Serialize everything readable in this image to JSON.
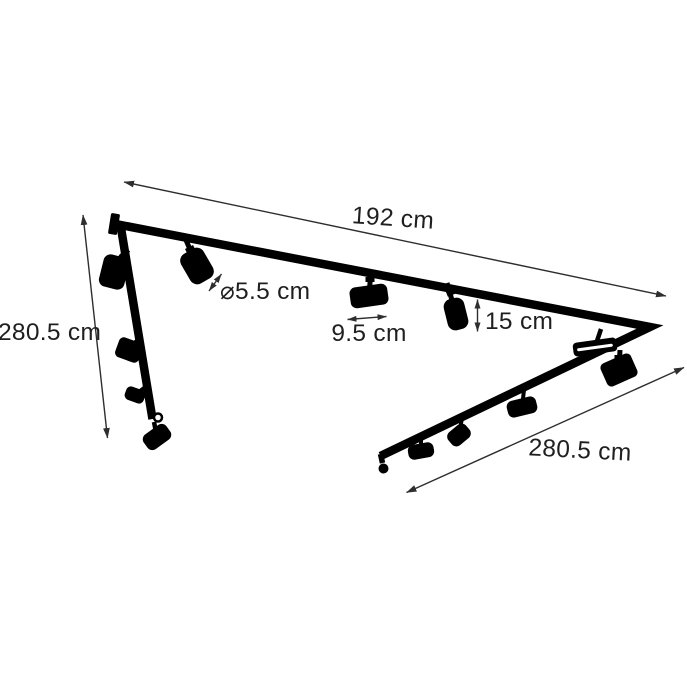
{
  "diagram": {
    "type": "product-dimension-diagram",
    "dimensions": {
      "top_track": "192 cm",
      "left_track": "280.5 cm",
      "right_track": "280.5 cm",
      "spot_diameter": "⌀5.5 cm",
      "spot_body_width": "9.5 cm",
      "spot_height": "15 cm"
    },
    "colors": {
      "background": "#ffffff",
      "artwork": "#000000",
      "dimension_lines": "#2e2e2e",
      "text": "#1f1f1f"
    }
  }
}
